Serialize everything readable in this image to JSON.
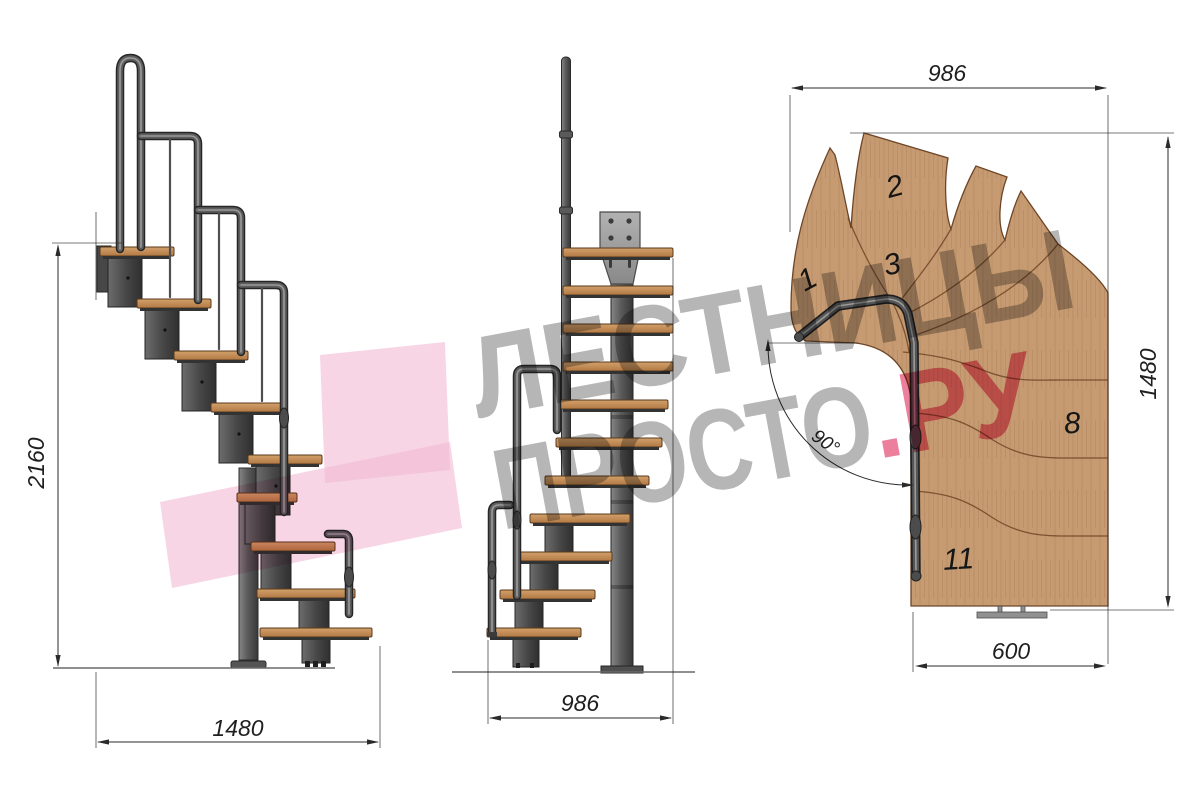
{
  "side_view": {
    "height_dim": "2160",
    "width_dim": "1480"
  },
  "front_view": {
    "width_dim": "986"
  },
  "plan_view": {
    "width_dim": "986",
    "height_dim": "1480",
    "depth_dim": "600",
    "angle_dim": "90°",
    "steps": [
      {
        "label": "1"
      },
      {
        "label": "2"
      },
      {
        "label": "3"
      },
      {
        "label": "8"
      },
      {
        "label": "11"
      }
    ]
  },
  "watermark": {
    "line1": "ЛЕСТНИЦЫ",
    "line2_grey": "ПРОСТО",
    "line2_pink": ".РУ"
  },
  "colors": {
    "wood": "#c79b72",
    "steel": "#4a4a4a",
    "dim": "#2a2a2a",
    "watermark_grey": "#a2a2a2",
    "watermark_pink": "#e8688b",
    "watermark_arrow": "#f2b9d3"
  }
}
